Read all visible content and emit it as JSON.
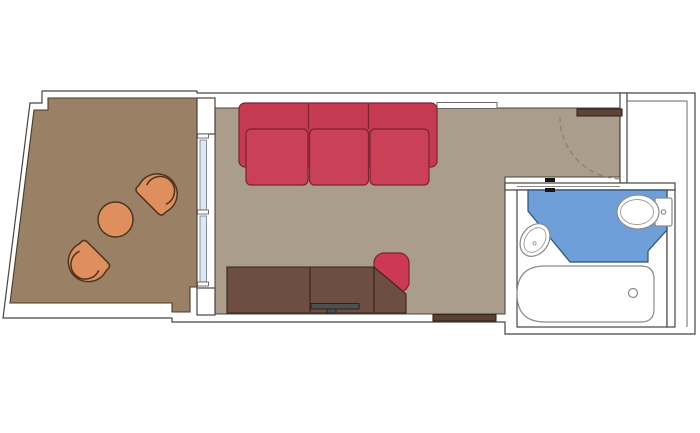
{
  "plan": {
    "name": "stateroom-floorplan",
    "rooms": [
      "balcony",
      "living-area",
      "entry",
      "bathroom"
    ],
    "furniture": [
      "sofa",
      "desk-tv-cabinet",
      "tv",
      "desk-chair",
      "balcony-chair",
      "balcony-table",
      "bathtub",
      "toilet",
      "washbasin",
      "entrance-door",
      "bathroom-door",
      "sliding-glass-door"
    ]
  },
  "colors": {
    "background": "#ffffff",
    "wall_fill": "#ffffff",
    "balcony_floor": "#9a8165",
    "room_floor": "#ab9d8c",
    "bathroom_fill": "#ffffff",
    "bathroom_wet_floor": "#6f9fd9",
    "fixture_white": "#ffffff",
    "sofa_red": "#c43a50",
    "sofa_cushion_red": "#ca4056",
    "chair_red": "#cb3a52",
    "armchair_orange": "#df8e5e",
    "wood_dark": "#6f4e42",
    "door_wood": "#5b4337",
    "strip_wood": "#5b4034",
    "tv_gray": "#4f4f4f",
    "glass_blue": "#dce8f4",
    "swing_arc": "#8a7a68",
    "handle_black": "#151515"
  }
}
